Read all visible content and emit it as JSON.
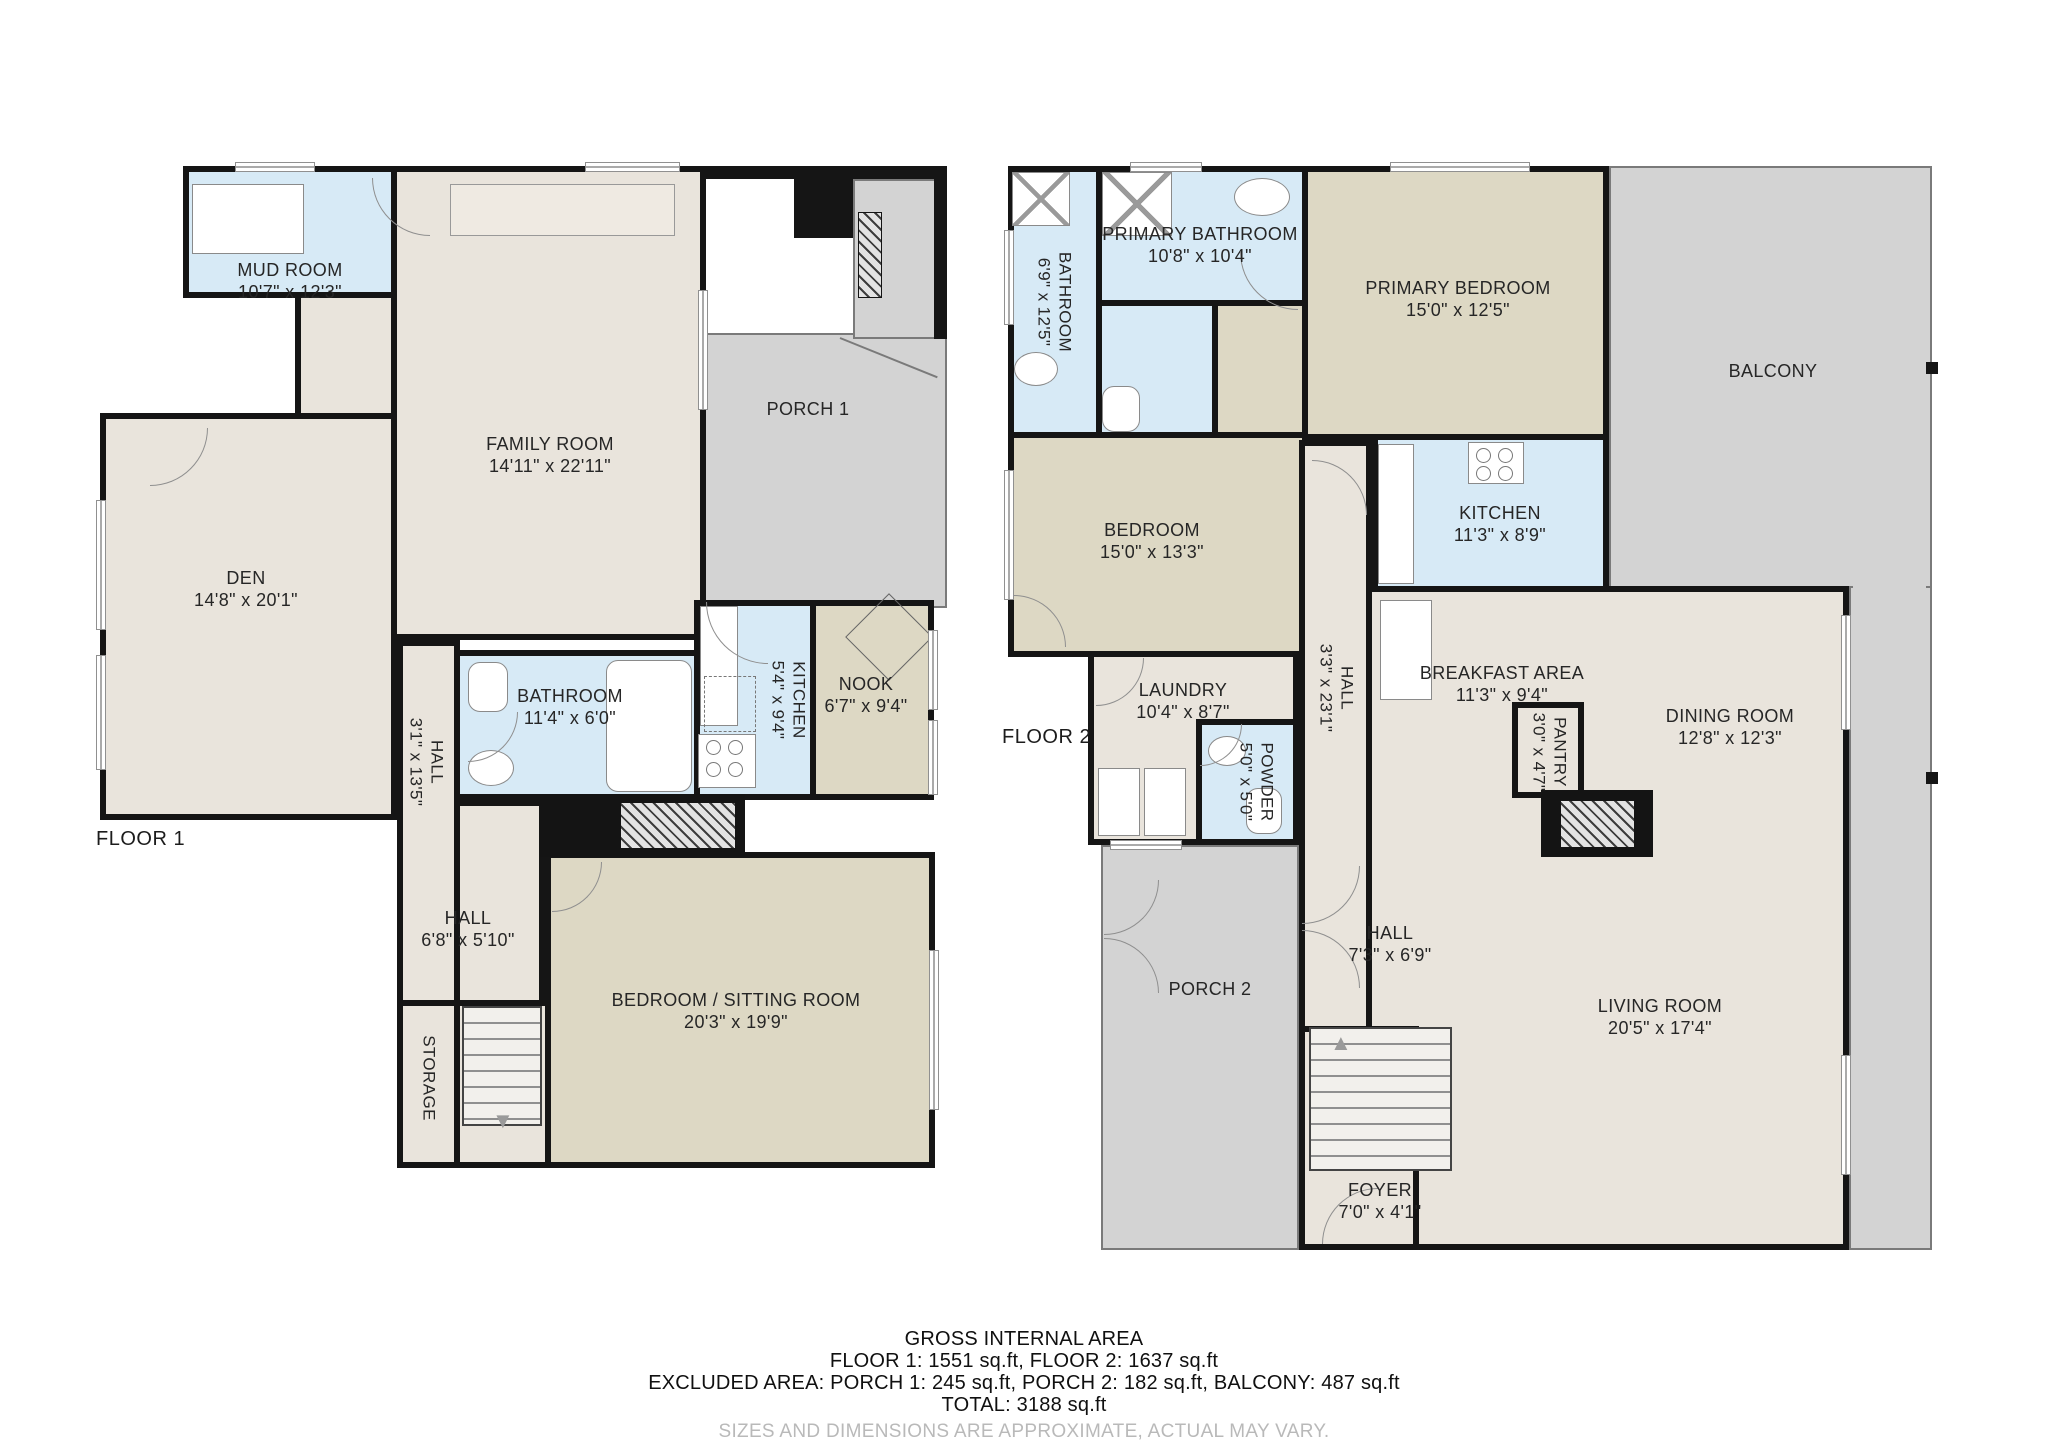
{
  "colors": {
    "wall": "#151515",
    "living_floor": "#e9e4dc",
    "bedroom_floor": "#ddd8c4",
    "wet_room": "#d7eaf6",
    "porch": "#d3d3d3"
  },
  "icons": {
    "stairs_down_arrow": "▼",
    "stairs_up_arrow": "▲"
  },
  "floor1": {
    "label": "FLOOR 1",
    "rooms": {
      "mudroom": {
        "name": "MUD ROOM",
        "dims": "10'7\" x 12'3\""
      },
      "familyroom": {
        "name": "FAMILY ROOM",
        "dims": "14'11\" x 22'11\""
      },
      "porch1": {
        "name": "PORCH 1",
        "dims": ""
      },
      "den": {
        "name": "DEN",
        "dims": "14'8\" x 20'1\""
      },
      "hall_a": {
        "name": "HALL",
        "dims": "3'1\" x 13'5\""
      },
      "bathroom": {
        "name": "BATHROOM",
        "dims": "11'4\" x 6'0\""
      },
      "kitchen": {
        "name": "KITCHEN",
        "dims": "5'4\" x 9'4\""
      },
      "nook": {
        "name": "NOOK",
        "dims": "6'7\" x 9'4\""
      },
      "hall_b": {
        "name": "HALL",
        "dims": "6'8\" x 5'10\""
      },
      "storage": {
        "name": "STORAGE",
        "dims": ""
      },
      "bedsitting": {
        "name": "BEDROOM / SITTING ROOM",
        "dims": "20'3\" x 19'9\""
      }
    }
  },
  "floor2": {
    "label": "FLOOR 2",
    "rooms": {
      "bathroom": {
        "name": "BATHROOM",
        "dims": "6'9\" x 12'5\""
      },
      "primary_bathroom": {
        "name": "PRIMARY BATHROOM",
        "dims": "10'8\" x 10'4\""
      },
      "primary_bedroom": {
        "name": "PRIMARY BEDROOM",
        "dims": "15'0\" x 12'5\""
      },
      "balcony": {
        "name": "BALCONY",
        "dims": ""
      },
      "bedroom": {
        "name": "BEDROOM",
        "dims": "15'0\" x 13'3\""
      },
      "kitchen": {
        "name": "KITCHEN",
        "dims": "11'3\" x 8'9\""
      },
      "hall_main": {
        "name": "HALL",
        "dims": "3'3\" x 23'1\""
      },
      "laundry": {
        "name": "LAUNDRY",
        "dims": "10'4\" x 8'7\""
      },
      "powder": {
        "name": "POWDER",
        "dims": "5'0\" x 5'0\""
      },
      "breakfast": {
        "name": "BREAKFAST AREA",
        "dims": "11'3\" x 9'4\""
      },
      "dining": {
        "name": "DINING ROOM",
        "dims": "12'8\" x 12'3\""
      },
      "pantry": {
        "name": "PANTRY",
        "dims": "3'0\" x 4'7\""
      },
      "porch2": {
        "name": "PORCH 2",
        "dims": ""
      },
      "hall_entry": {
        "name": "HALL",
        "dims": "7'3\" x 6'9\""
      },
      "foyer": {
        "name": "FOYER",
        "dims": "7'0\" x 4'1\""
      },
      "living": {
        "name": "LIVING ROOM",
        "dims": "20'5\" x 17'4\""
      }
    }
  },
  "footer": {
    "title": "GROSS INTERNAL AREA",
    "areas": "FLOOR 1: 1551 sq.ft, FLOOR 2: 1637 sq.ft",
    "excluded": "EXCLUDED AREA: PORCH 1: 245 sq.ft, PORCH 2: 182 sq.ft, BALCONY: 487 sq.ft",
    "total": "TOTAL: 3188 sq.ft",
    "disclaimer": "SIZES AND DIMENSIONS ARE APPROXIMATE, ACTUAL MAY VARY."
  }
}
